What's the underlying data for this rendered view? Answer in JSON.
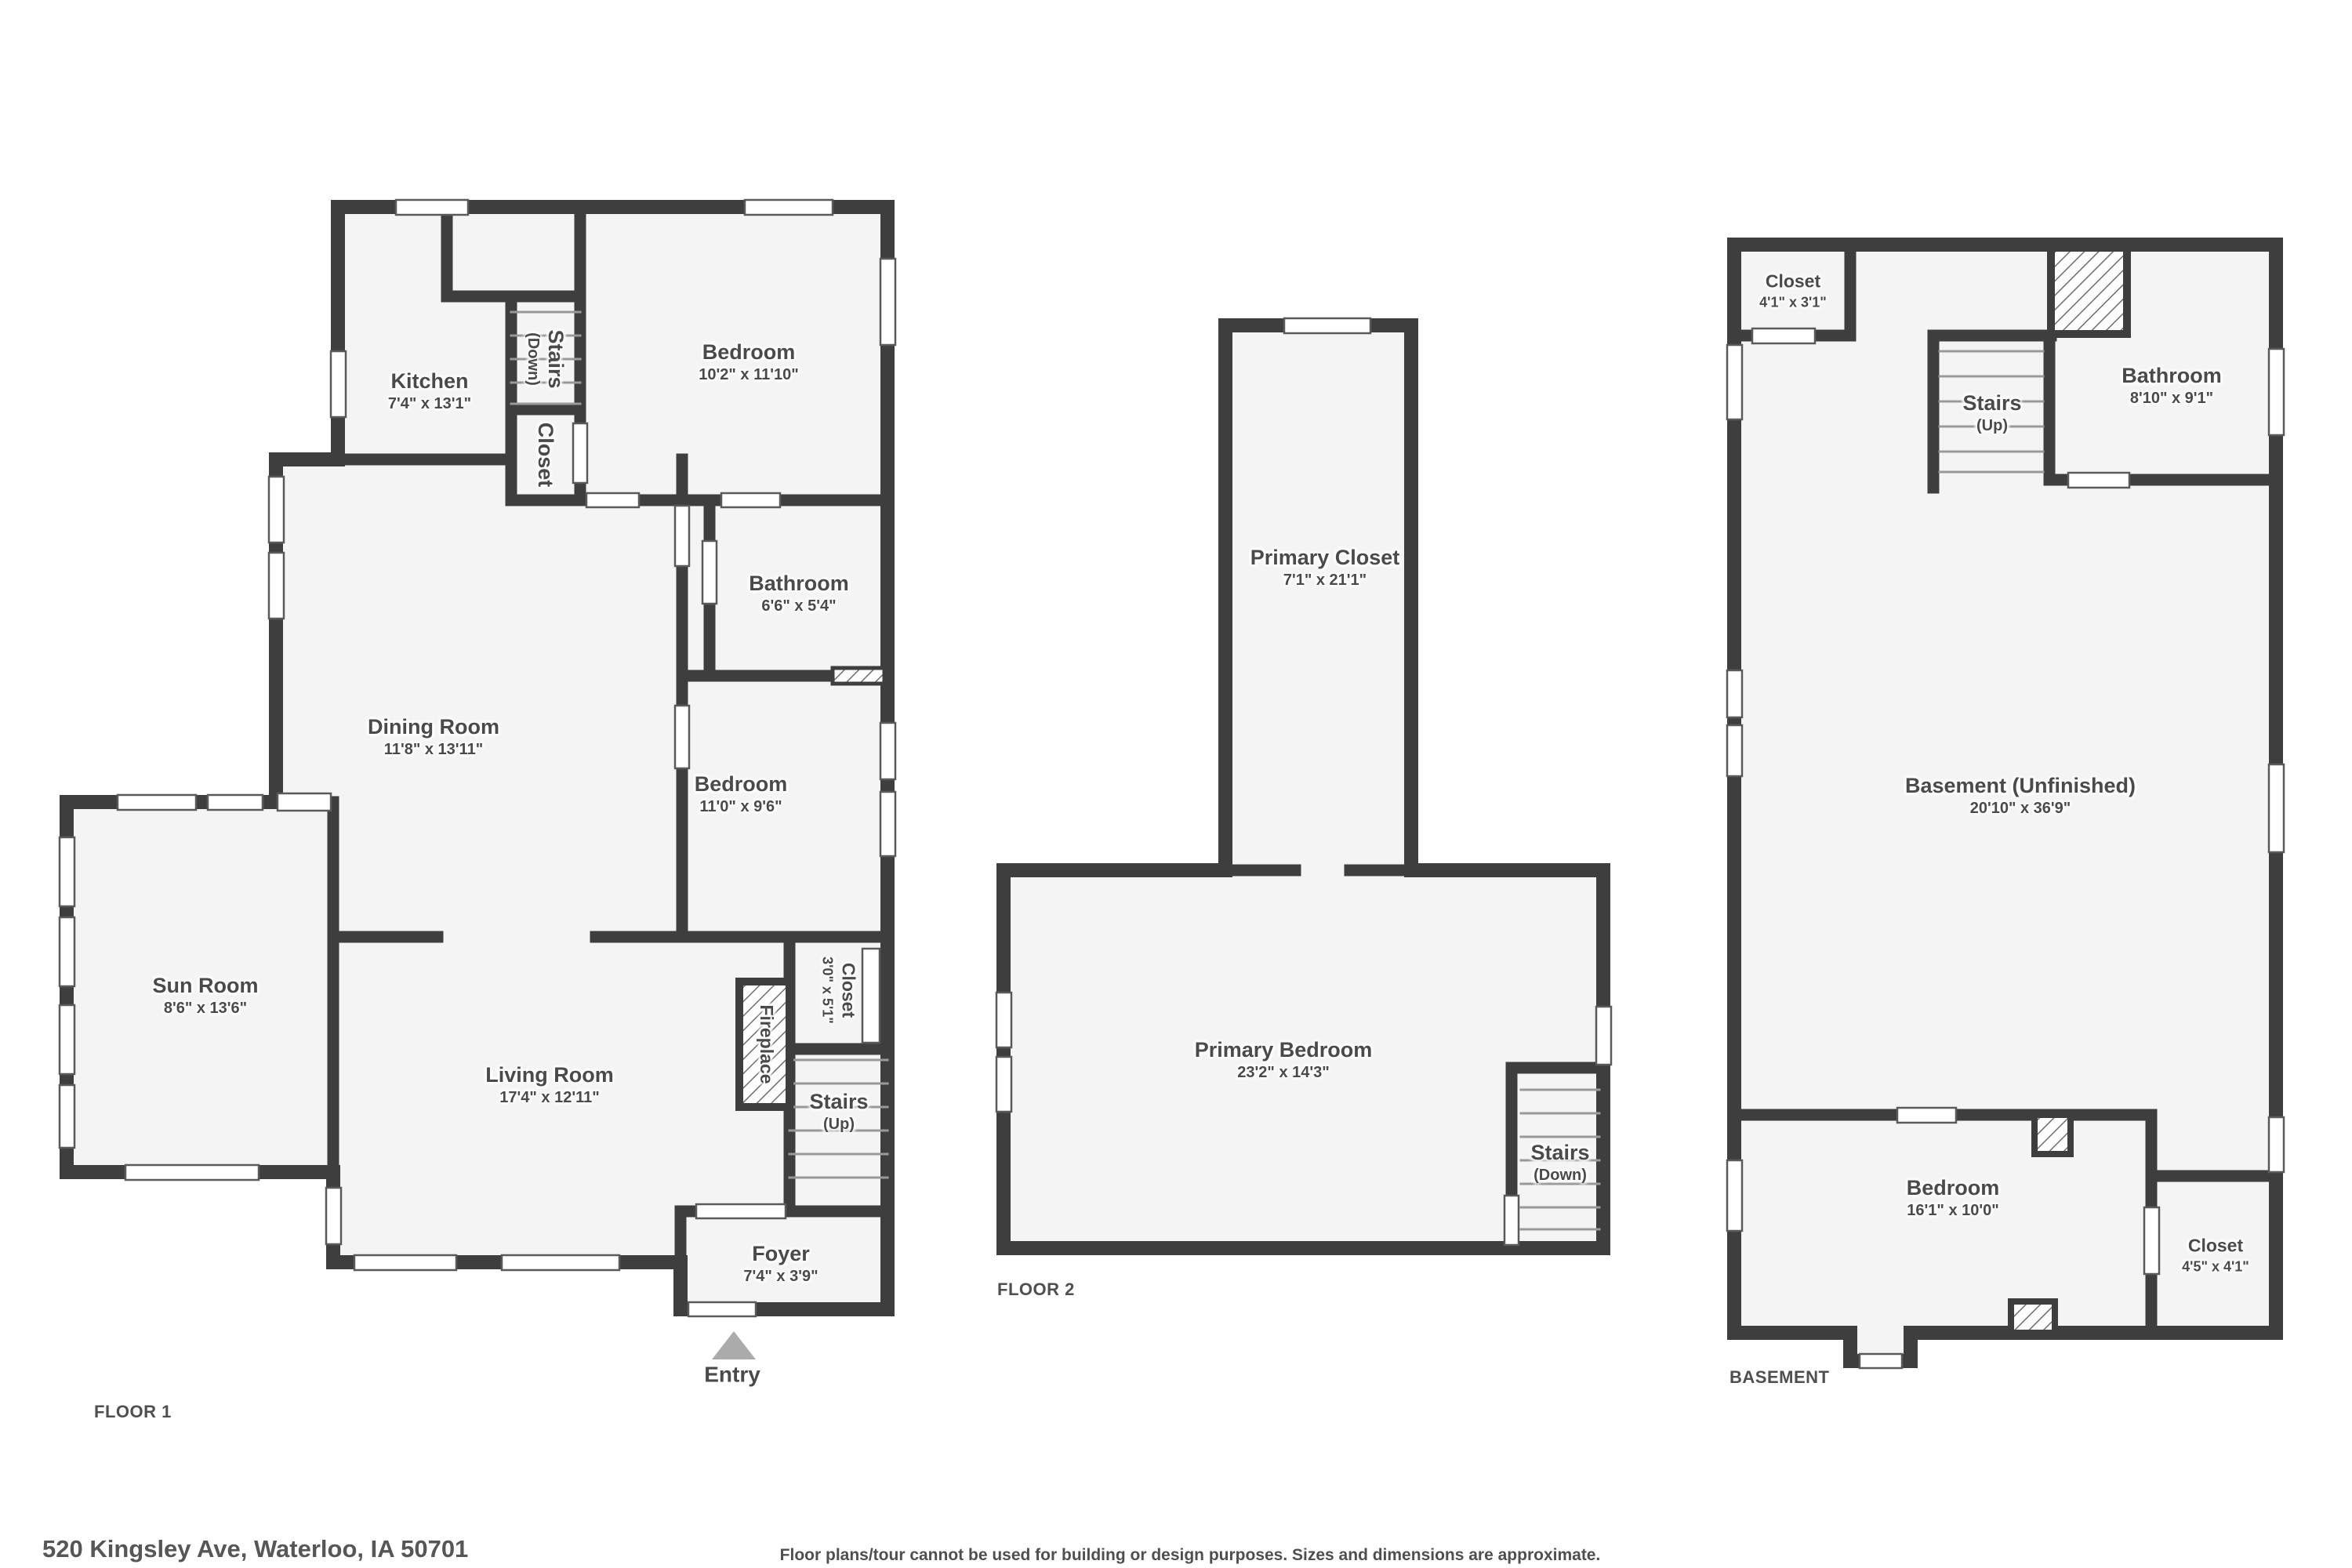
{
  "floor1": {
    "title": "FLOOR 1",
    "rooms": {
      "kitchen": {
        "name": "Kitchen",
        "dims": "7'4\" x 13'1\""
      },
      "stairs_down": {
        "name": "Stairs",
        "dims": "(Down)"
      },
      "closet_stairs": {
        "name": "Closet",
        "dims": ""
      },
      "bedroom_top": {
        "name": "Bedroom",
        "dims": "10'2\" x 11'10\""
      },
      "bathroom": {
        "name": "Bathroom",
        "dims": "6'6\" x 5'4\""
      },
      "bedroom_mid": {
        "name": "Bedroom",
        "dims": "11'0\" x 9'6\""
      },
      "dining_room": {
        "name": "Dining Room",
        "dims": "11'8\" x 13'11\""
      },
      "sun_room": {
        "name": "Sun Room",
        "dims": "8'6\" x 13'6\""
      },
      "living_room": {
        "name": "Living Room",
        "dims": "17'4\" x 12'11\""
      },
      "closet_hall": {
        "name": "Closet",
        "dims": "3'0\" x 5'1\""
      },
      "fireplace": {
        "name": "Fireplace",
        "dims": ""
      },
      "stairs_up": {
        "name": "Stairs",
        "dims": "(Up)"
      },
      "foyer": {
        "name": "Foyer",
        "dims": "7'4\" x 3'9\""
      },
      "entry": {
        "name": "Entry",
        "dims": ""
      }
    }
  },
  "floor2": {
    "title": "FLOOR 2",
    "rooms": {
      "primary_closet": {
        "name": "Primary Closet",
        "dims": "7'1\" x 21'1\""
      },
      "primary_bedroom": {
        "name": "Primary Bedroom",
        "dims": "23'2\" x 14'3\""
      },
      "stairs_down": {
        "name": "Stairs",
        "dims": "(Down)"
      }
    }
  },
  "basement": {
    "title": "BASEMENT",
    "rooms": {
      "closet_top": {
        "name": "Closet",
        "dims": "4'1\" x 3'1\""
      },
      "stairs_up": {
        "name": "Stairs",
        "dims": "(Up)"
      },
      "bathroom": {
        "name": "Bathroom",
        "dims": "8'10\" x 9'1\""
      },
      "main": {
        "name": "Basement (Unfinished)",
        "dims": "20'10\" x 36'9\""
      },
      "bedroom": {
        "name": "Bedroom",
        "dims": "16'1\" x 10'0\""
      },
      "closet_bed": {
        "name": "Closet",
        "dims": "4'5\" x 4'1\""
      }
    }
  },
  "footer": {
    "address": "520 Kingsley Ave, Waterloo, IA 50701",
    "disclaimer": "Floor plans/tour cannot be used for building or design purposes. Sizes and dimensions are approximate."
  },
  "colors": {
    "wall": "#3e3e3e",
    "floor": "#f4f4f4",
    "text": "#4a4a4a",
    "window": "#ffffff",
    "entry_arrow": "#ababab",
    "stair_tread": "#999999"
  }
}
